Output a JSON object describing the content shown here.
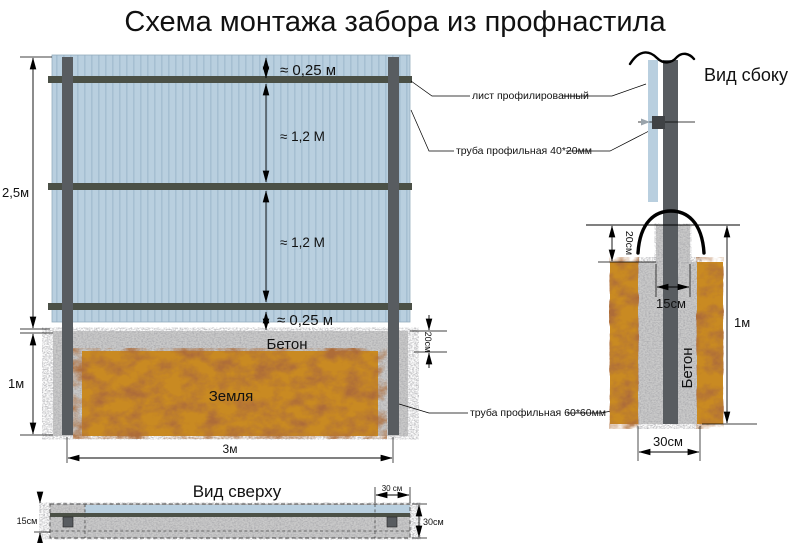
{
  "title": "Схема монтажа забора из профнастила",
  "colors": {
    "sheet": "#b9cfdf",
    "sheet_stripe": "#a6bfd2",
    "post": "#585c60",
    "rail": "#4b5046",
    "concrete": "#cacaca",
    "earth": "#c98a20",
    "connector": "#3f4245"
  },
  "front_view": {
    "dim_top_gap": "≈ 0,25 м",
    "dim_panel1": "≈ 1,2 М",
    "dim_panel2": "≈ 1,2 М",
    "dim_bottom_gap": "≈ 0,25 м",
    "dim_height": "2,5м",
    "dim_foundation_depth": "1м",
    "dim_span": "3м",
    "dim_concrete_layer": "20см",
    "label_concrete": "Бетон",
    "label_earth": "Земля"
  },
  "side_view": {
    "title": "Вид сбоку",
    "dim_collar": "20см",
    "dim_hole": "15см",
    "dim_depth": "1м",
    "dim_width": "30см",
    "label_concrete": "Бетон"
  },
  "top_view": {
    "title": "Вид сверху",
    "dim_half_width": "15см",
    "dim_post_zone": "30 см",
    "dim_width": "30см"
  },
  "callouts": {
    "sheet": "лист профилированный",
    "rail": "труба профильная 40*20мм",
    "post": "труба профильная 60*60мм"
  }
}
